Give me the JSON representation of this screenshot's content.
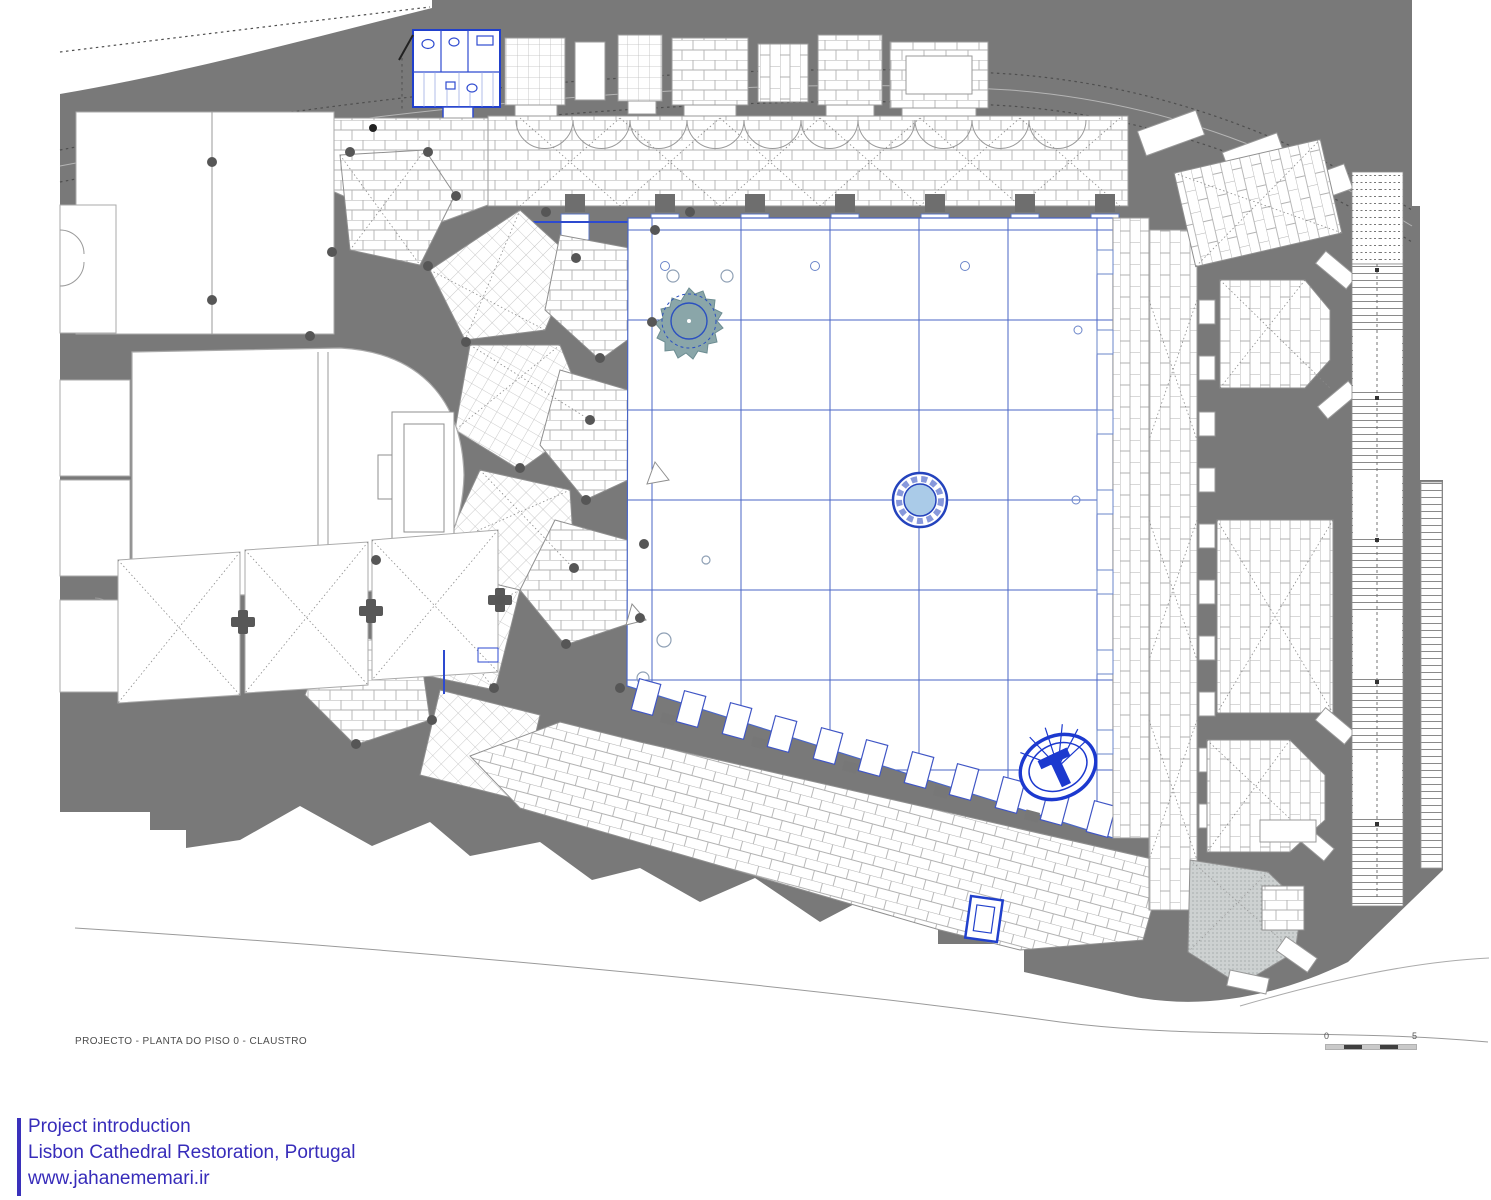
{
  "document": {
    "type": "architectural-floor-plan",
    "caption": "PROJECTO - PLANTA DO PISO 0 - CLAUSTRO"
  },
  "scale_bar": {
    "start_label": "0",
    "end_label": "5"
  },
  "footer": {
    "line1": "Project introduction",
    "line2": "Lisbon Cathedral Restoration, Portugal",
    "line3": "www.jahanememari.ir",
    "accent_color": "#3a31bb"
  },
  "palette": {
    "wall_poche_gray": "#797979",
    "hatch_line_gray": "#b2b2b2",
    "pier_dark_gray": "#565656",
    "courtyard_grid_blue": "#4a66c6",
    "new_work_blue": "#2140cc",
    "fountain_fill_blue": "#aacbe8",
    "tree_fill_teal": "#8aa6a9",
    "chapel_dot_gray": "#cdd1d1"
  },
  "plan_features": [
    "street-band",
    "street-dashed-contours",
    "north-service-rooms",
    "wc-block-blue",
    "north-gallery",
    "west-chapel-fan",
    "apse-chancel",
    "nave-rooms",
    "vault-bays",
    "cloister-courtyard",
    "courtyard-grid",
    "tree-circle",
    "central-fountain",
    "south-gallery",
    "south-arcade-piers",
    "east-gallery",
    "east-chapels",
    "gray-hatched-chapel",
    "long-staircase",
    "spiral-stair-oval",
    "blue-well-square",
    "street-curve-south"
  ]
}
